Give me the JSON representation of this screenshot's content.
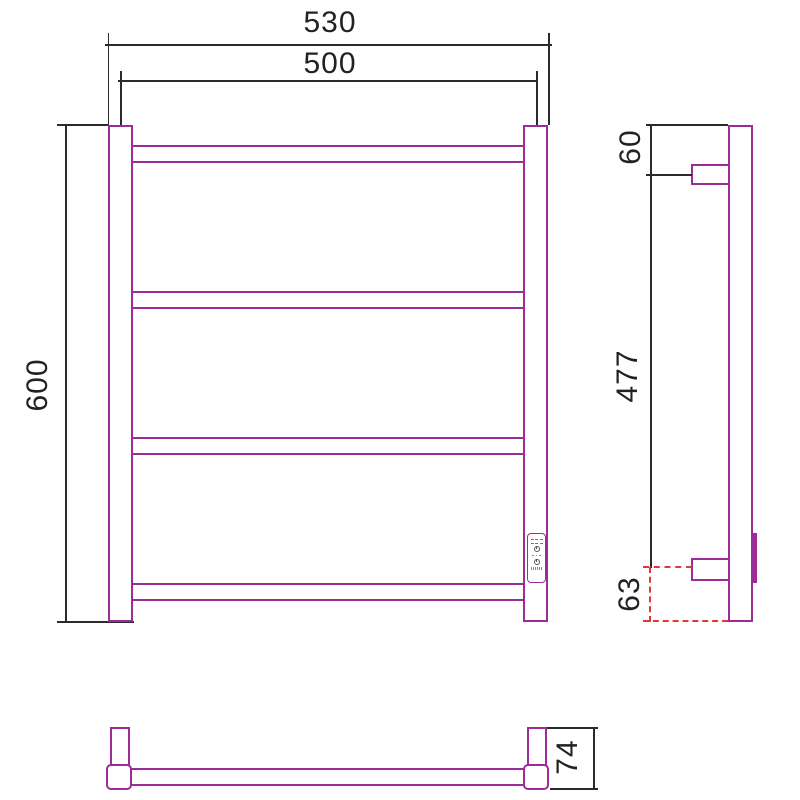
{
  "drawing": {
    "type": "technical-drawing",
    "subject": "ladder-style heated towel rail, three orthographic views",
    "front_view": {
      "width_overall_mm": "530",
      "width_between_post_centers_mm": "500",
      "height_mm": "600",
      "bar_count": 4
    },
    "side_view": {
      "top_to_upper_bracket_mm": "60",
      "bracket_span_mm": "477",
      "lower_bracket_to_bottom_mm": "63"
    },
    "bottom_view": {
      "depth_mm": "74"
    }
  },
  "control_panel": {
    "icons": [
      "segment-display",
      "clock-icon",
      "level-dots",
      "power-icon",
      "on-off-label"
    ]
  },
  "colors": {
    "product_line": "#9d2b9a",
    "dimension_line": "#2b2b2b",
    "reference_dashed": "#e03a34",
    "background": "#ffffff"
  }
}
